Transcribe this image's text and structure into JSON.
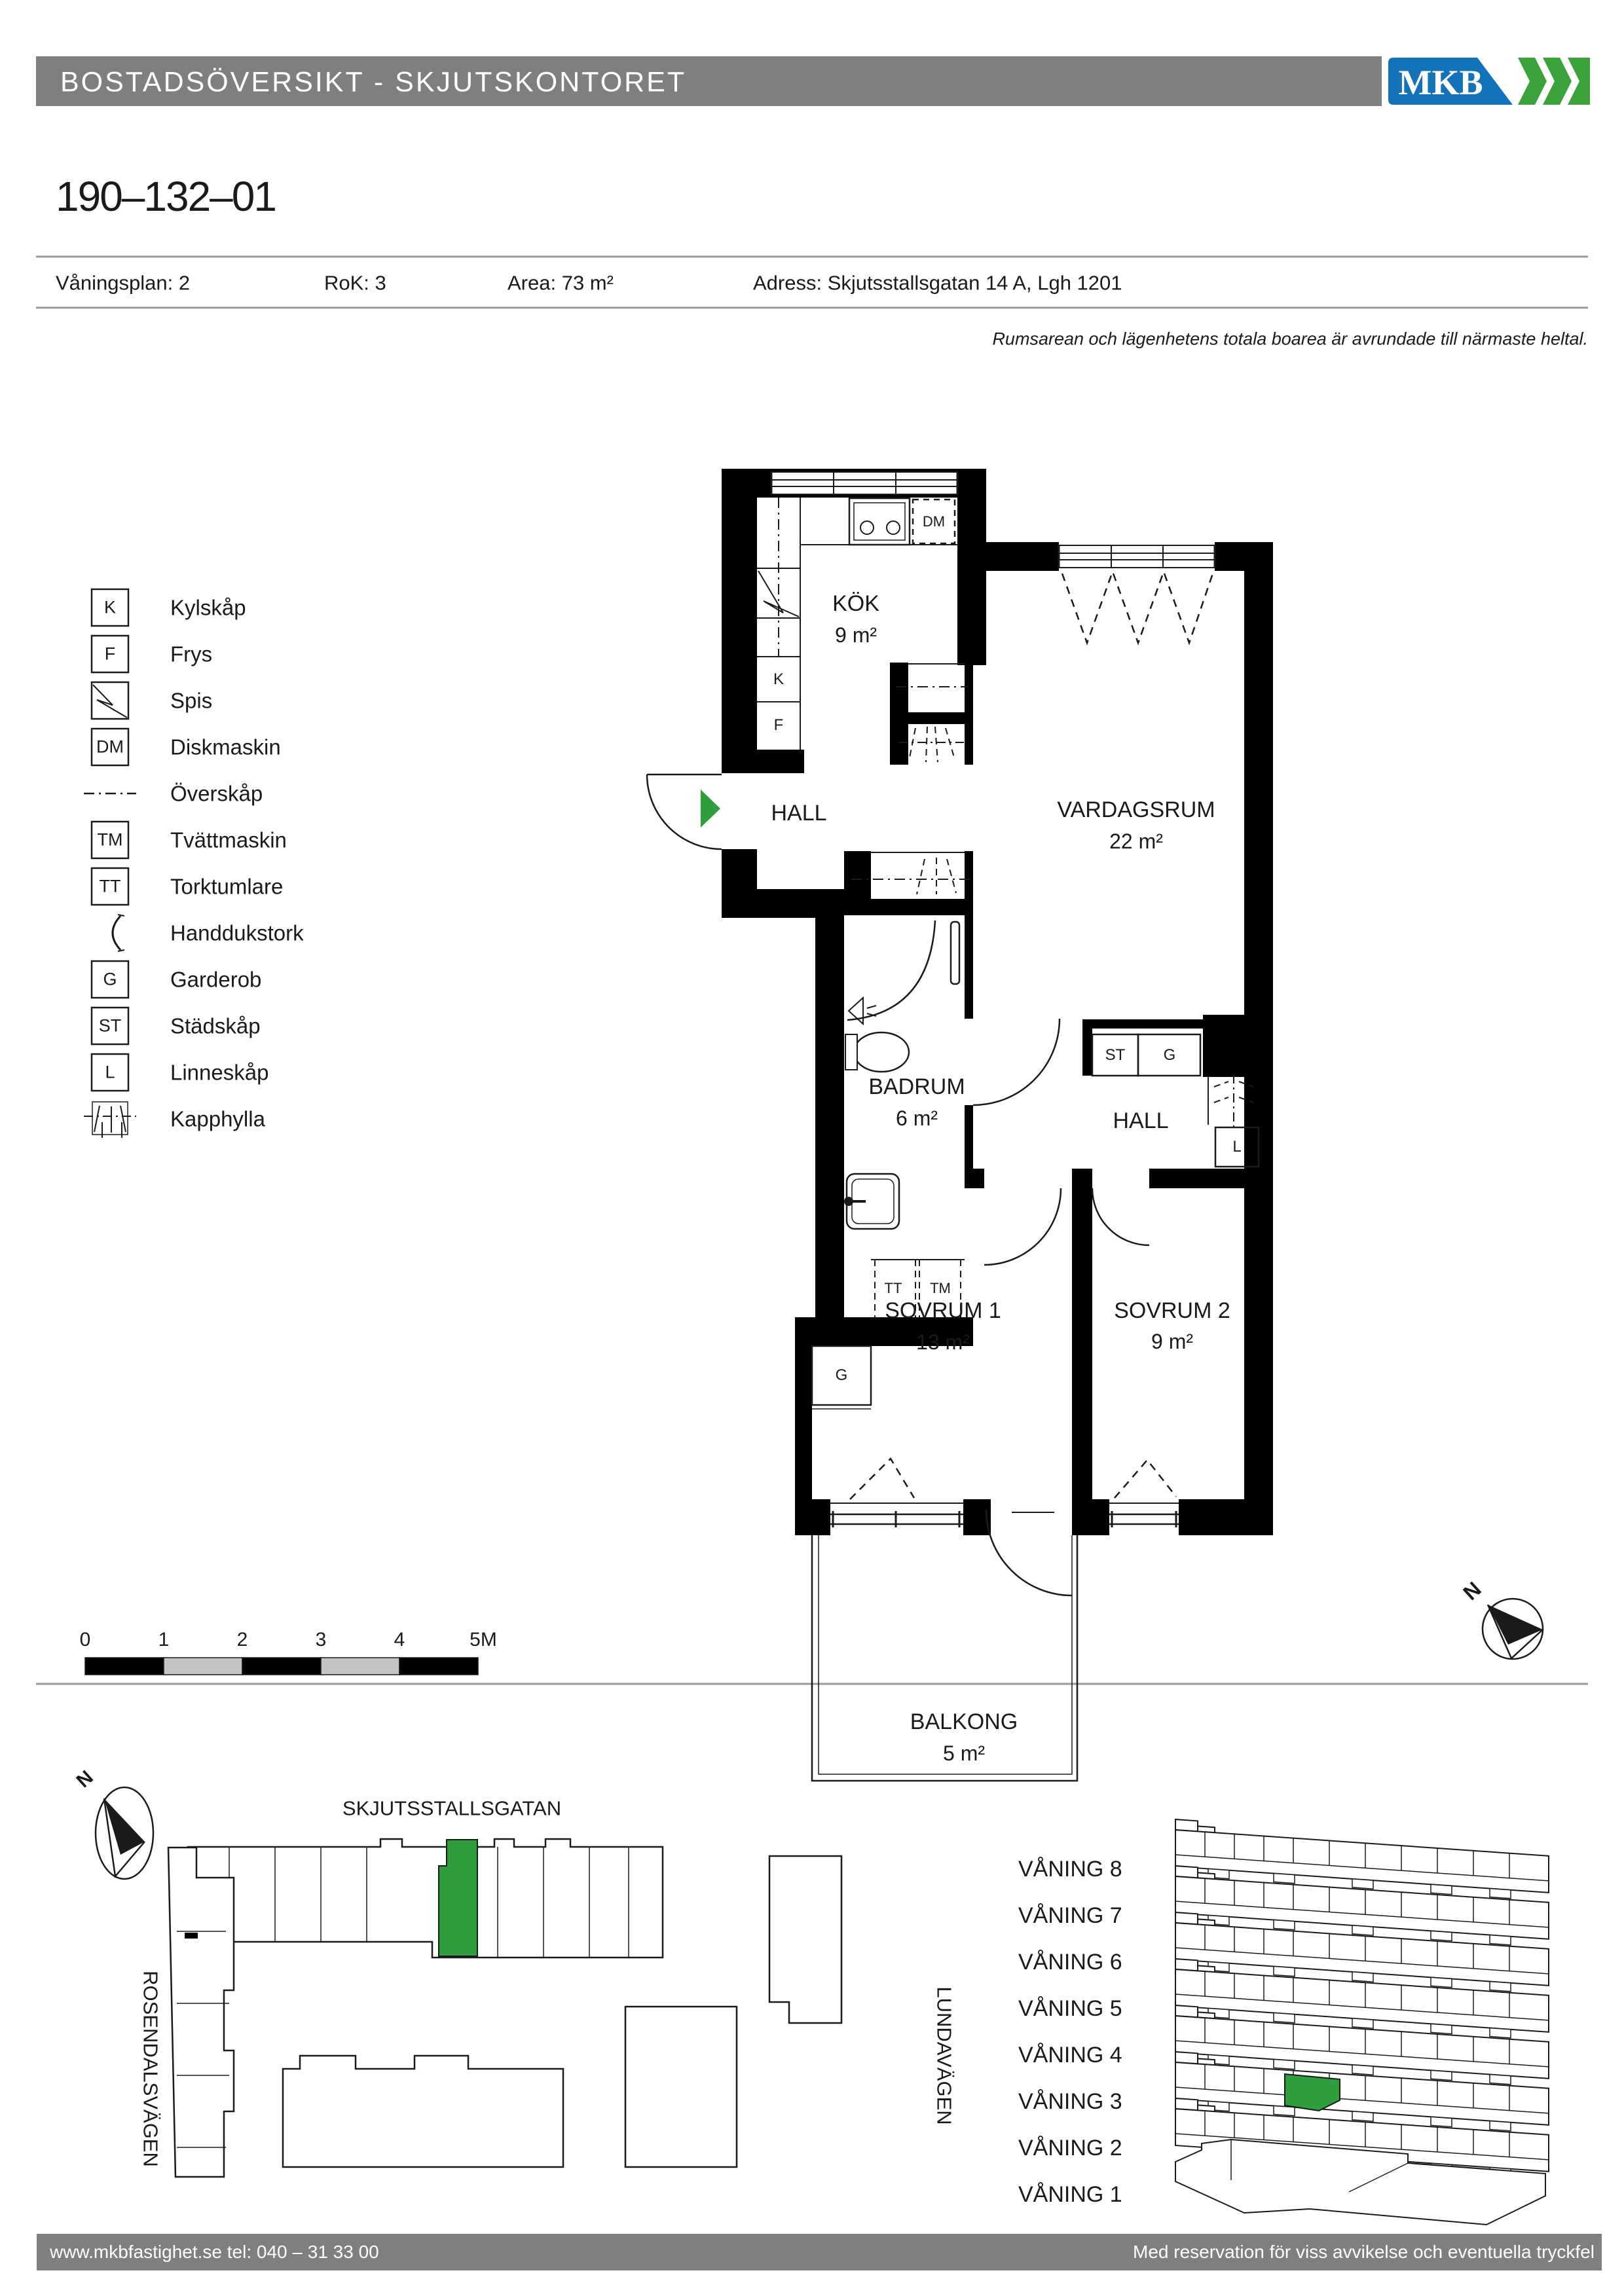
{
  "colors": {
    "header_gray": "#7f7f7f",
    "brand_blue": "#1473b8",
    "brand_green": "#3ca23c",
    "highlight_green": "#2f9e3c",
    "scale_gray": "#c4c4c4",
    "line_gray": "#999999"
  },
  "header": {
    "title": "BOSTADSÖVERSIKT - SKJUTSKONTORET",
    "logo_text": "MKB"
  },
  "apartment": {
    "id": "190–132–01",
    "vaningsplan": "Våningsplan: 2",
    "rok": "RoK: 3",
    "area": "Area: 73 m²",
    "adress": "Adress: Skjutsstallsgatan 14 A, Lgh 1201"
  },
  "note": "Rumsarean och lägenhetens totala boarea är avrundade till närmaste heltal.",
  "legend": {
    "items": [
      {
        "symbol": "K",
        "label": "Kylskåp"
      },
      {
        "symbol": "F",
        "label": "Frys"
      },
      {
        "symbol": "",
        "label": "Spis"
      },
      {
        "symbol": "DM",
        "label": "Diskmaskin"
      },
      {
        "symbol": "",
        "label": "Överskåp"
      },
      {
        "symbol": "TM",
        "label": "Tvättmaskin"
      },
      {
        "symbol": "TT",
        "label": "Torktumlare"
      },
      {
        "symbol": "",
        "label": "Handdukstork"
      },
      {
        "symbol": "G",
        "label": "Garderob"
      },
      {
        "symbol": "ST",
        "label": "Städskåp"
      },
      {
        "symbol": "L",
        "label": "Linneskåp"
      },
      {
        "symbol": "",
        "label": "Kapphylla"
      }
    ]
  },
  "floor_plan": {
    "rooms": {
      "kok": "KÖK",
      "kok_area": "9 m²",
      "hall_entry": "HALL",
      "vardagsrum": "VARDAGSRUM",
      "vardagsrum_area": "22 m²",
      "badrum": "BADRUM",
      "badrum_area": "6 m²",
      "hall_inner": "HALL",
      "sovrum1": "SOVRUM 1",
      "sovrum1_area": "13 m²",
      "sovrum2": "SOVRUM 2",
      "sovrum2_area": "9 m²",
      "balkong": "BALKONG",
      "balkong_area": "5 m²"
    },
    "fixtures": {
      "dm": "DM",
      "k": "K",
      "f": "F",
      "tt": "TT",
      "tm": "TM",
      "g_sovrum": "G",
      "st": "ST",
      "g_hall": "G",
      "l": "L"
    }
  },
  "scale_bar": {
    "ticks": [
      "0",
      "1",
      "2",
      "3",
      "4",
      "5M"
    ]
  },
  "compass": {
    "label": "N"
  },
  "site_map": {
    "north": "N",
    "streets": {
      "top": "SKJUTSSTALLSGATAN",
      "left": "ROSENDALSVÄGEN",
      "right": "LUNDAVÄGEN"
    }
  },
  "floor_stack": {
    "floors": [
      "VÅNING 8",
      "VÅNING 7",
      "VÅNING 6",
      "VÅNING 5",
      "VÅNING 4",
      "VÅNING 3",
      "VÅNING 2",
      "VÅNING 1"
    ],
    "highlighted_floor": "VÅNING 3"
  },
  "footer": {
    "left": "www.mkbfastighet.se   tel: 040 – 31 33 00",
    "right": "Med reservation för viss avvikelse och eventuella tryckfel"
  }
}
